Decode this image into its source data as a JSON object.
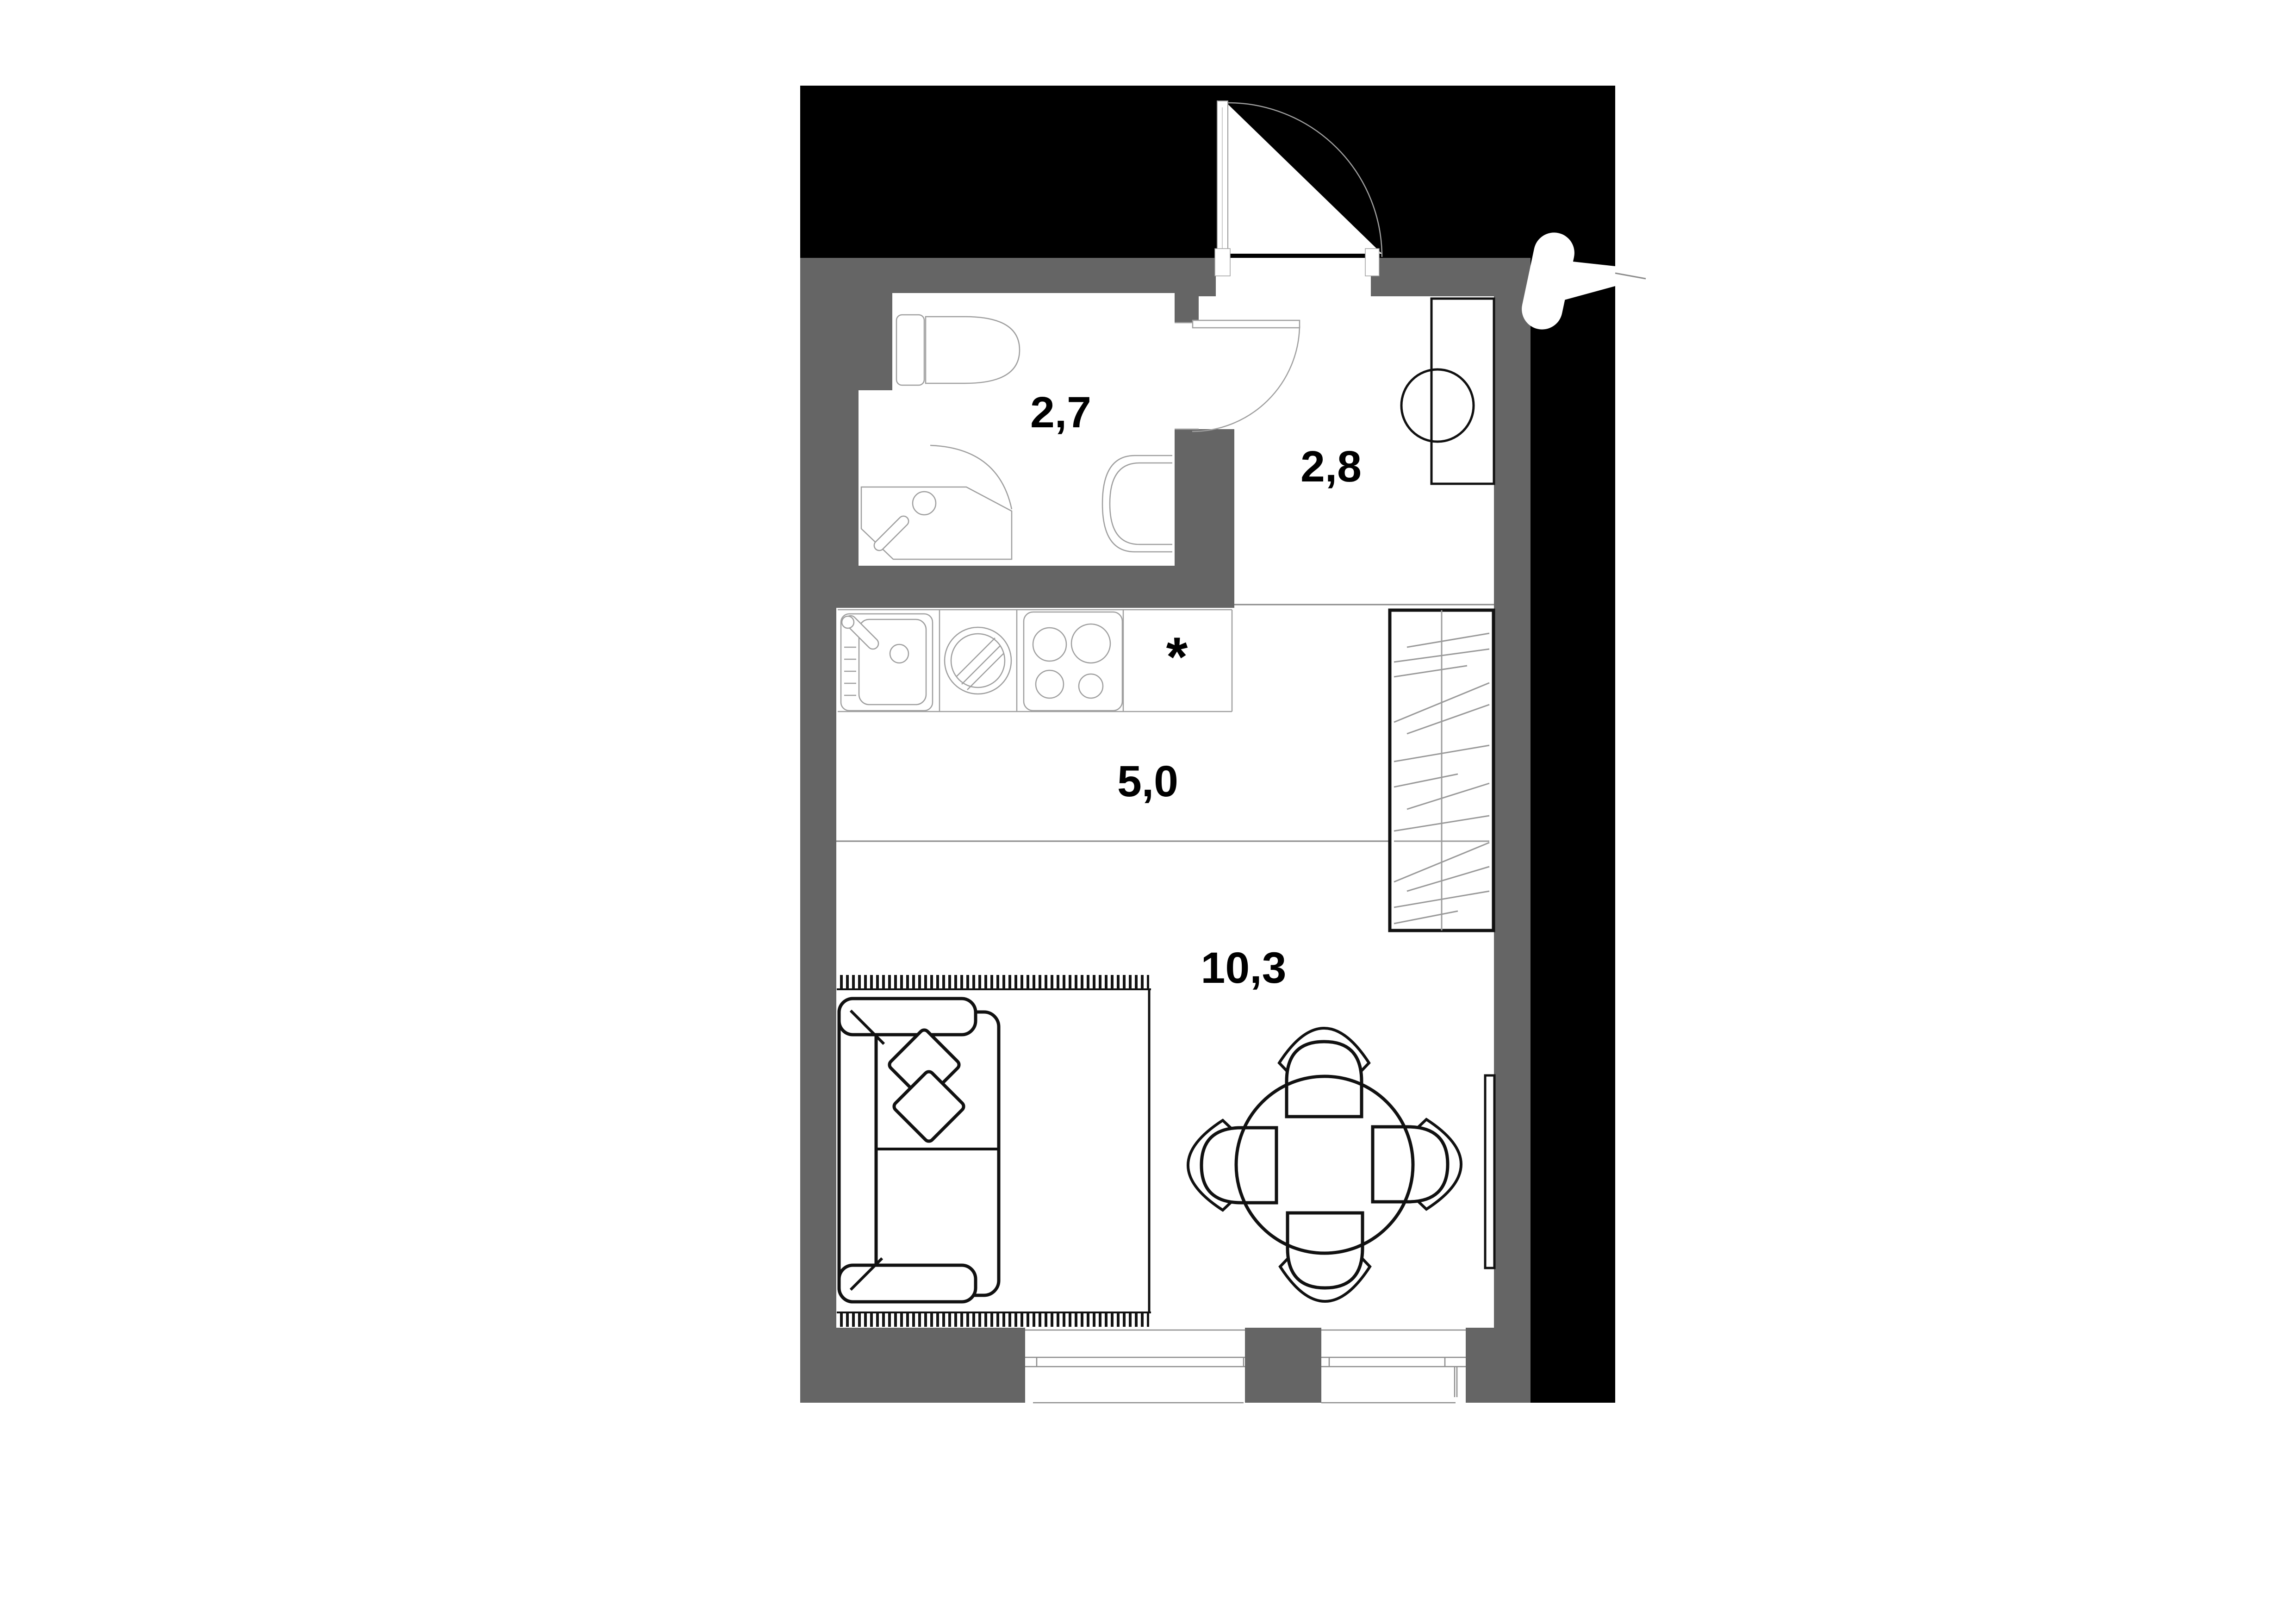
{
  "plan": {
    "type": "apartment-floor-plan-studio",
    "rooms": {
      "bathroom": {
        "label": "2,7"
      },
      "hallway": {
        "label": "2,8"
      },
      "kitchen": {
        "label": "5,0"
      },
      "living": {
        "label": "10,3"
      }
    },
    "annotations": {
      "kitchen_star": "*"
    },
    "colors": {
      "outside_mass": "#000000",
      "wall_fill": "#656565",
      "floor_fill": "#ffffff",
      "furniture_stroke": "#111111",
      "fixture_stroke": "#9f9f9f",
      "zone_line": "#8a8a8a",
      "label_color": "#000000"
    }
  }
}
